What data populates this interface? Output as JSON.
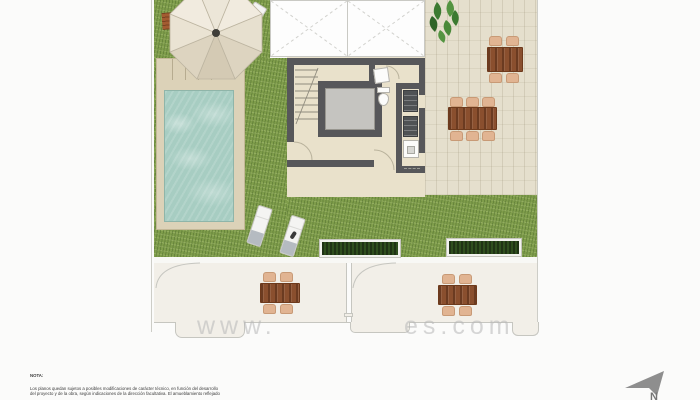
{
  "plan": {
    "kind": "roof-terrace floor plan",
    "palette": {
      "grass": "#7f9d4b",
      "deck": "#e5dfcd",
      "wall": "#57575a",
      "pool_water": "#a7cdc2",
      "pool_deck": "#dcd2b8",
      "balcony": "#f2efe8",
      "wood_table": "#8a4f2e",
      "chair": "#e1b492",
      "lounger": "#f4f4f2",
      "lounger_accent": "#b5bbc1",
      "planter": "#2f4e1e",
      "parasol": "#ece5d6"
    },
    "furniture": {
      "parasol": 1,
      "bench": 1,
      "sun_loungers": 3,
      "dining_tables": 4,
      "chairs": 18,
      "planters": 2,
      "toilet": 1,
      "elevator": 1,
      "stairs": 1
    }
  },
  "note": {
    "heading": "NOTA:",
    "lines": [
      "Los planos quedan sujetos a posibles modificaciones de carácter técnico, en función del desarrollo",
      "del proyecto y de la obra, según indicaciones de la dirección facultativa. El amueblamiento reflejado"
    ]
  },
  "watermark": {
    "prefix": "www.",
    "suffix": "es.com"
  },
  "compass": {
    "label": "N"
  }
}
